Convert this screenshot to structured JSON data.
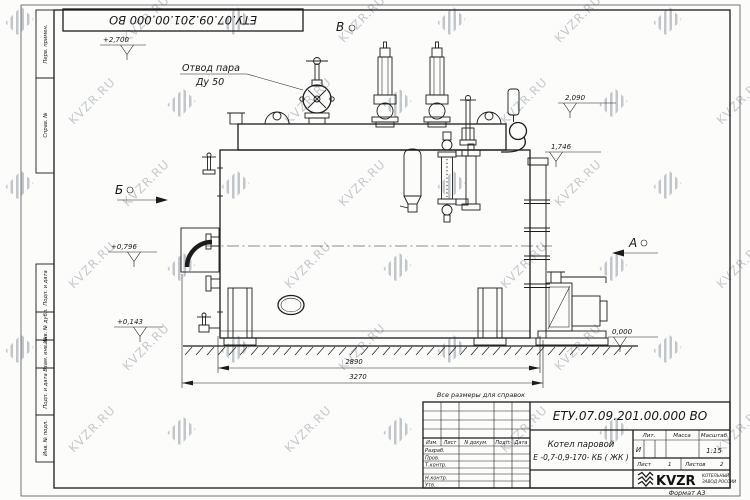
{
  "page": {
    "format_note": "Формат А3",
    "reference_note": "Все размеры для справок"
  },
  "watermark": {
    "text": "KVZR.RU"
  },
  "corner_stamp": {
    "designation": "ЕТУ.07.09.201.00.000  ВО"
  },
  "margin_columns": {
    "perv_primen": "Перв. примен.",
    "sprav_no": "Справ. №",
    "podp_data_1": "Подп. и дата",
    "inv_dubl": "Инв. № дубл.",
    "vzam_inv": "Взам. инв. №",
    "podp_data_2": "Подп. и дата",
    "inv_podl": "Инв. № подл."
  },
  "drawing": {
    "callout_line1": "Отвод пара",
    "callout_line2": "Ду 50",
    "view_top": "В",
    "view_left": "Б",
    "view_right": "А",
    "elev_2700": "+2,700",
    "elev_2090": "2,090",
    "elev_1746": "1,746",
    "elev_0796": "+0,796",
    "elev_0143": "+0,143",
    "elev_0000": "0,000",
    "dim_inner": "2890",
    "dim_overall": "3270"
  },
  "title_block": {
    "designation": "ЕТУ.07.09.201.00.000  ВО",
    "product_name_line1": "Котел паровой",
    "product_name_line2": "Е -0,7-0,9-170- КБ ( ЖК )",
    "col_izm": "Изм.",
    "col_list": "Лист",
    "col_ndokum": "N докум.",
    "col_podp": "Подп.",
    "col_data": "Дата",
    "row_razrab": "Разраб.",
    "row_prov": "Пров.",
    "row_tkontr": "Т.контр.",
    "row_nkontr": "Н.контр.",
    "row_utv": "Утв.",
    "lit_header": "Лит.",
    "mass_header": "Масса",
    "scale_header": "Масштаб",
    "lit_value": "И",
    "scale_value": "1:15",
    "sheet_label": "Лист",
    "sheet_value": "1",
    "sheets_label": "Листов",
    "sheets_value": "2",
    "company_name": "KVZR",
    "company_tagline1": "КОТЕЛЬНЫЙ",
    "company_tagline2": "ЗАВОД РОССИИ"
  }
}
